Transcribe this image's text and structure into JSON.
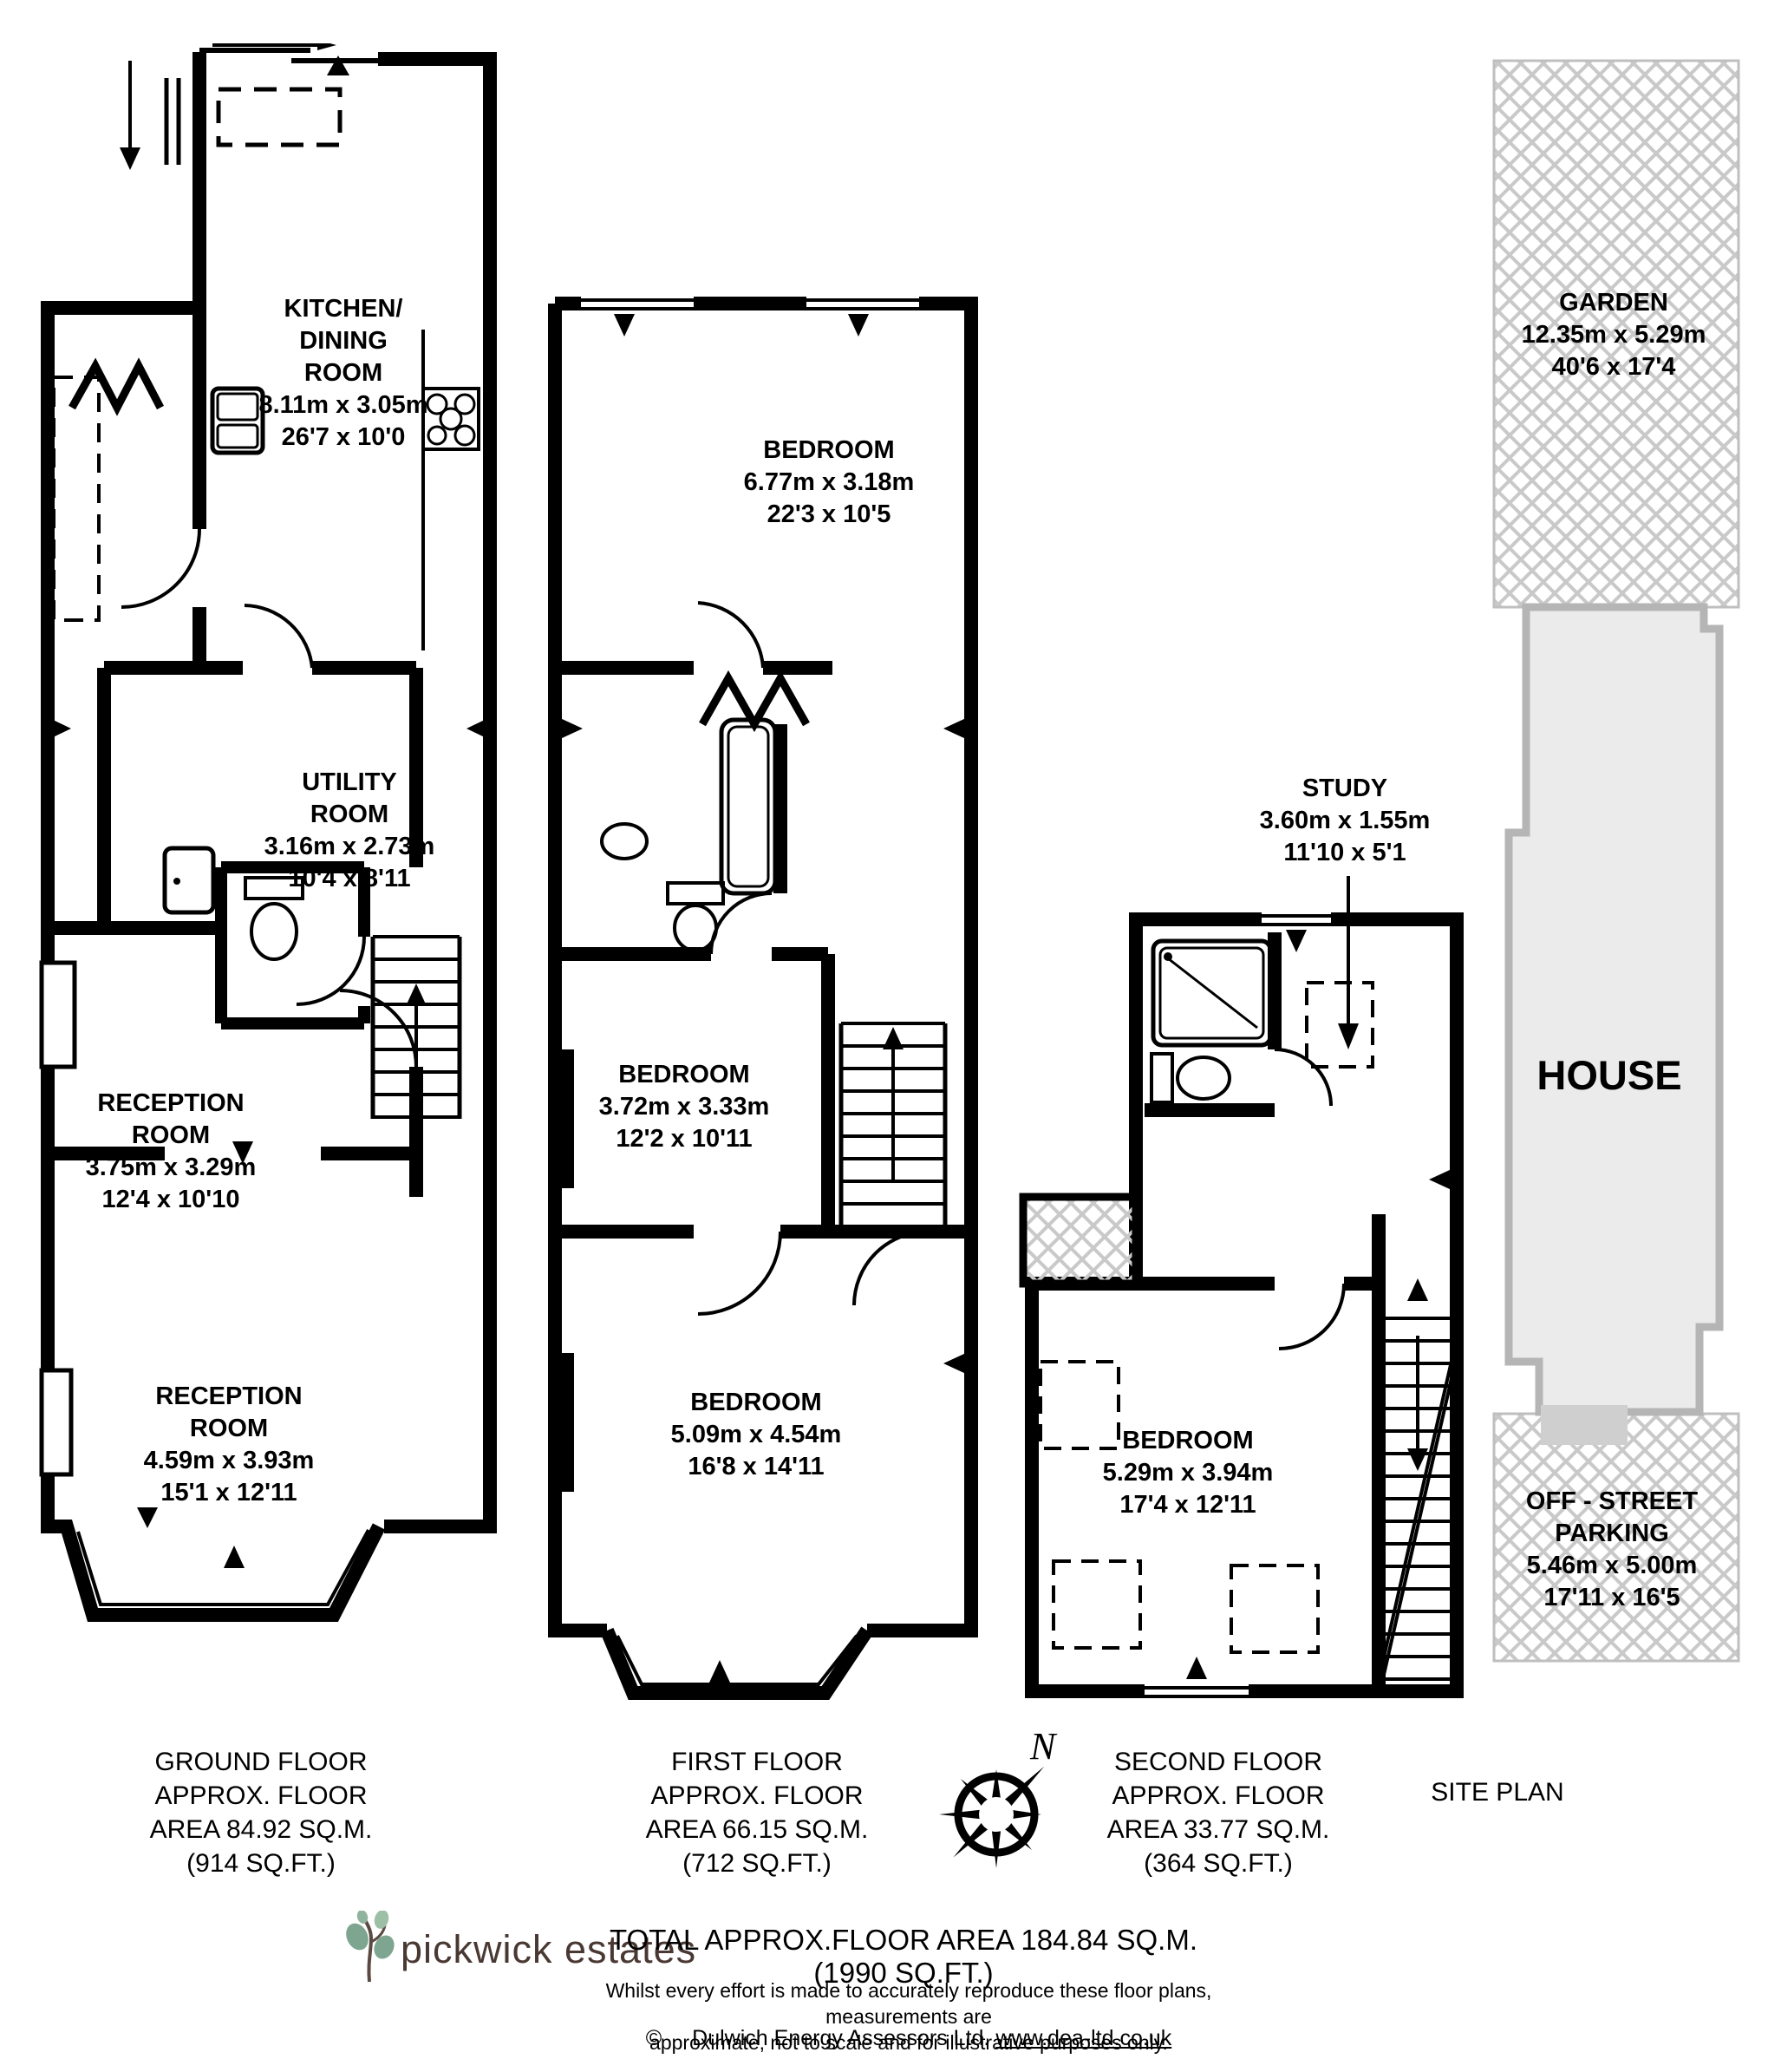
{
  "floors": {
    "ground": {
      "caption": "GROUND FLOOR\nAPPROX. FLOOR\nAREA 84.92 SQ.M.\n(914 SQ.FT.)",
      "rooms": {
        "kitchen": {
          "name": "KITCHEN/\nDINING\nROOM",
          "metric": "8.11m x 3.05m",
          "imperial": "26'7 x 10'0"
        },
        "utility": {
          "name": "UTILITY\nROOM",
          "metric": "3.16m x 2.73m",
          "imperial": "10'4 x 8'11"
        },
        "reception1": {
          "name": "RECEPTION\nROOM",
          "metric": "3.75m x 3.29m",
          "imperial": "12'4 x 10'10"
        },
        "reception2": {
          "name": "RECEPTION\nROOM",
          "metric": "4.59m x 3.93m",
          "imperial": "15'1 x 12'11"
        }
      }
    },
    "first": {
      "caption": "FIRST FLOOR\nAPPROX. FLOOR\nAREA 66.15 SQ.M.\n(712 SQ.FT.)",
      "rooms": {
        "bedroom1": {
          "name": "BEDROOM",
          "metric": "6.77m x 3.18m",
          "imperial": "22'3 x 10'5"
        },
        "bedroom2": {
          "name": "BEDROOM",
          "metric": "3.72m x 3.33m",
          "imperial": "12'2 x 10'11"
        },
        "bedroom3": {
          "name": "BEDROOM",
          "metric": "5.09m x 4.54m",
          "imperial": "16'8 x 14'11"
        }
      }
    },
    "second": {
      "caption": "SECOND FLOOR\nAPPROX. FLOOR\nAREA 33.77 SQ.M.\n(364 SQ.FT.)",
      "rooms": {
        "study": {
          "name": "STUDY",
          "metric": "3.60m x 1.55m",
          "imperial": "11'10 x 5'1"
        },
        "bedroom": {
          "name": "BEDROOM",
          "metric": "5.29m x 3.94m",
          "imperial": "17'4 x 12'11"
        }
      }
    }
  },
  "site": {
    "caption": "SITE PLAN",
    "garden": {
      "name": "GARDEN",
      "metric": "12.35m x 5.29m",
      "imperial": "40'6 x 17'4"
    },
    "house": {
      "name": "HOUSE"
    },
    "parking": {
      "name": "OFF - STREET\nPARKING",
      "metric": "5.46m x 5.00m",
      "imperial": "17'11 x 16'5"
    }
  },
  "compass": {
    "label": "N"
  },
  "branding": {
    "logo": "pickwick estates"
  },
  "summary": {
    "total": "TOTAL APPROX.FLOOR AREA 184.84 SQ.M. (1990 SQ.FT.)",
    "disclaimer": "Whilst every effort is made to accurately reproduce these floor plans, measurements are\napproximate, not to scale and for illustrative purposes only.",
    "copyright_symbol": "©",
    "copyright_owner": "Dulwich Energy Assessors Ltd.",
    "copyright_url": "www.dea-ltd.co.uk"
  },
  "colors": {
    "wall": "#000000",
    "house_fill": "#ebebeb",
    "house_border": "#b5b5b5",
    "hatch": "#c9c9c9",
    "logo_text": "#4a3833",
    "leaf": "#7ea590"
  }
}
